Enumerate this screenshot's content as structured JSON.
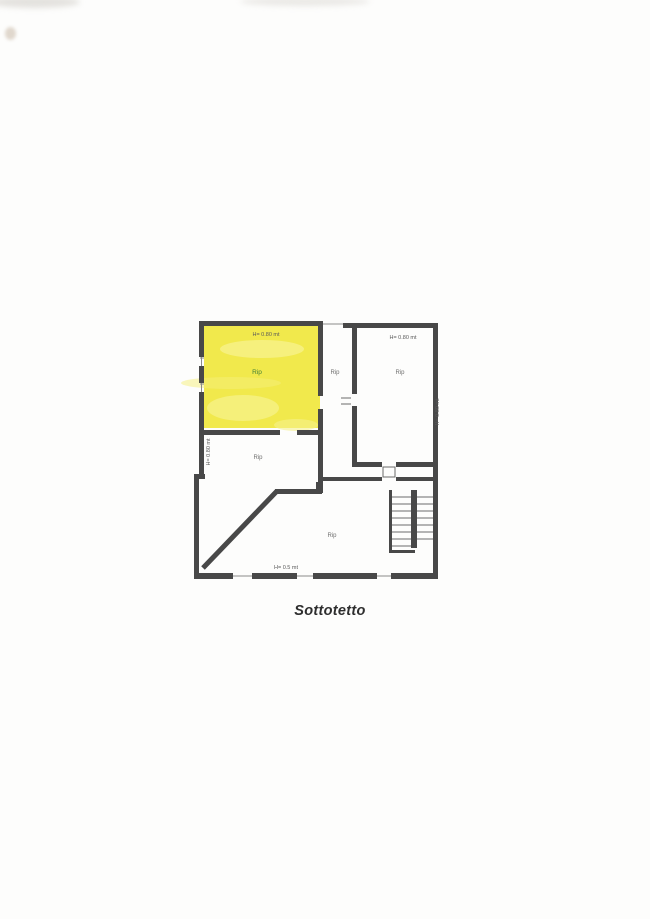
{
  "page": {
    "title": "Sottotetto"
  },
  "plan": {
    "highlight_color": "#f1e94c",
    "highlight_streak_color": "#f7f28e",
    "wall_color": "#484848",
    "highlighted_label_color": "#3f7d35",
    "label_color": "#6e6e6e",
    "annotation_color": "#5a5a5a",
    "rooms": [
      {
        "id": "yellow-room",
        "label": "Rip",
        "highlighted": true
      },
      {
        "id": "corridor",
        "label": "Rip",
        "highlighted": false
      },
      {
        "id": "right-room",
        "label": "Rip",
        "highlighted": false
      },
      {
        "id": "left-middle-room",
        "label": "Rip",
        "highlighted": false
      },
      {
        "id": "bottom-room",
        "label": "Rip",
        "highlighted": false
      }
    ],
    "annotations": {
      "yellow_room_height": "H= 0.80 mt",
      "right_room_height": "H= 0.80 mt",
      "left_wall_height": "H= 0.80 mt",
      "right_wall_height": "H= 0.80 mt",
      "bottom_height": "H= 0.5 mt"
    }
  }
}
